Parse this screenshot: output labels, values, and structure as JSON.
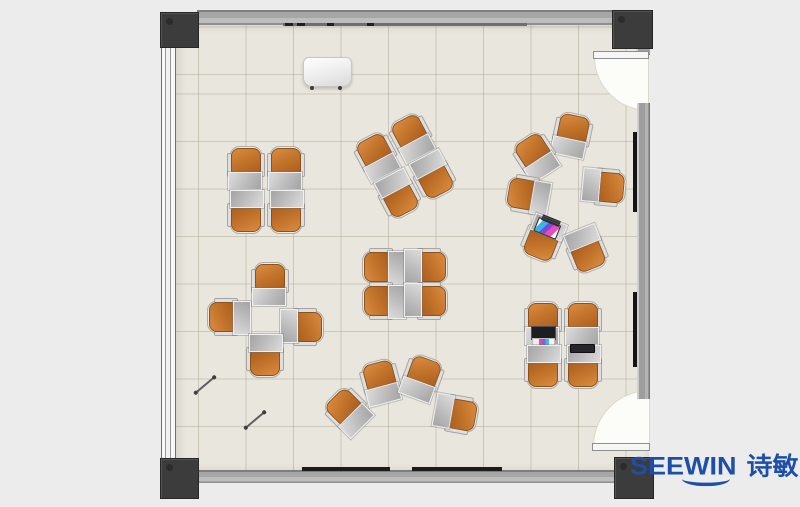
{
  "meta": {
    "type": "floor-plan",
    "description": "Classroom / training room furniture layout top view"
  },
  "brand": {
    "logo_text": "SEEWIN",
    "logo_cjk": "诗敏",
    "logo_color": "#1d4fa8",
    "smile_icon": "smile-arc"
  },
  "palette": {
    "background": "#ececec",
    "floor": "#e9e6dd",
    "tile_line": "#b0aa98",
    "wall": "#a6a6a6",
    "corner_post": "#3c3c3c",
    "chair_orange": "#c4752c",
    "desk_gray": "#bfbfbf",
    "board_black": "#141414"
  },
  "floor_plan": {
    "total_seats": 30,
    "clusters": [
      {
        "id": "square-top-left",
        "arrangement": "2x2 facing pairs",
        "seats": 4,
        "cx": 266,
        "cy": 190,
        "rot": 0,
        "units": [
          {
            "dx": -20,
            "dy": -22,
            "r": 0
          },
          {
            "dx": 20,
            "dy": -22,
            "r": 0
          },
          {
            "dx": -20,
            "dy": 22,
            "r": 180
          },
          {
            "dx": 20,
            "dy": 22,
            "r": 180
          }
        ]
      },
      {
        "id": "square-rotated",
        "arrangement": "2x2 facing pairs, rotated",
        "seats": 4,
        "cx": 405,
        "cy": 166,
        "rot": -28,
        "units": [
          {
            "dx": -20,
            "dy": -22,
            "r": 0
          },
          {
            "dx": 20,
            "dy": -22,
            "r": 0
          },
          {
            "dx": -20,
            "dy": 22,
            "r": 180
          },
          {
            "dx": 20,
            "dy": 22,
            "r": 180
          }
        ]
      },
      {
        "id": "circle-right",
        "arrangement": "circle facing center",
        "seats": 6,
        "cx": 560,
        "cy": 193,
        "rot": 0,
        "units": [
          {
            "dx": 12,
            "dy": -58,
            "r": 12
          },
          {
            "dx": -24,
            "dy": -37,
            "r": -33
          },
          {
            "dx": -32,
            "dy": 2,
            "r": -80
          },
          {
            "dx": -17,
            "dy": 46,
            "r": -158,
            "laptop": "open-colorful"
          },
          {
            "dx": 26,
            "dy": 57,
            "r": 158
          },
          {
            "dx": 44,
            "dy": -6,
            "r": 95
          }
        ]
      },
      {
        "id": "pinwheel-left",
        "arrangement": "pinwheel around center",
        "seats": 4,
        "cx": 266,
        "cy": 320,
        "rot": 0,
        "units": [
          {
            "dx": 4,
            "dy": -36,
            "r": 0
          },
          {
            "dx": -37,
            "dy": -3,
            "r": -90
          },
          {
            "dx": 36,
            "dy": 7,
            "r": 90
          },
          {
            "dx": -1,
            "dy": 36,
            "r": 180
          }
        ]
      },
      {
        "id": "square-center",
        "arrangement": "2x2 facing pairs, side-on",
        "seats": 4,
        "cx": 405,
        "cy": 284,
        "rot": 0,
        "units": [
          {
            "dx": -21,
            "dy": -17,
            "r": -90
          },
          {
            "dx": 21,
            "dy": -17,
            "r": 90
          },
          {
            "dx": -21,
            "dy": 17,
            "r": -90
          },
          {
            "dx": 21,
            "dy": 17,
            "r": 90
          }
        ]
      },
      {
        "id": "fan-bottom",
        "arrangement": "fan arc",
        "seats": 4,
        "cx": 400,
        "cy": 398,
        "rot": 0,
        "units": [
          {
            "dx": -52,
            "dy": 13,
            "r": -45
          },
          {
            "dx": -19,
            "dy": -16,
            "r": -15
          },
          {
            "dx": 22,
            "dy": -20,
            "r": 20
          },
          {
            "dx": 56,
            "dy": 16,
            "r": 100
          }
        ]
      },
      {
        "id": "square-bottom-right",
        "arrangement": "2x2 facing pairs",
        "seats": 4,
        "cx": 563,
        "cy": 345,
        "rot": 0,
        "units": [
          {
            "dx": -20,
            "dy": -22,
            "r": 0,
            "laptop": "open-dark"
          },
          {
            "dx": 20,
            "dy": -22,
            "r": 0
          },
          {
            "dx": -20,
            "dy": 22,
            "r": 180
          },
          {
            "dx": 20,
            "dy": 22,
            "r": 180,
            "laptop": "closed"
          }
        ]
      }
    ],
    "objects": {
      "podium": {
        "x": 303,
        "y": 57,
        "w": 47,
        "h": 28
      },
      "pens": [
        {
          "x": 205,
          "y": 385,
          "r": -40
        },
        {
          "x": 255,
          "y": 420,
          "r": -40
        }
      ],
      "whiteboard_rail_top": {
        "x": 283,
        "y": 23,
        "w": 244
      },
      "rails_bottom": [
        {
          "x": 302,
          "w": 88
        },
        {
          "x": 412,
          "w": 90
        }
      ],
      "boards_right": [
        {
          "y": 132,
          "h": 80
        },
        {
          "y": 292,
          "h": 75
        }
      ],
      "doors": [
        "top-right swing-in",
        "bottom-right swing-in"
      ]
    }
  }
}
